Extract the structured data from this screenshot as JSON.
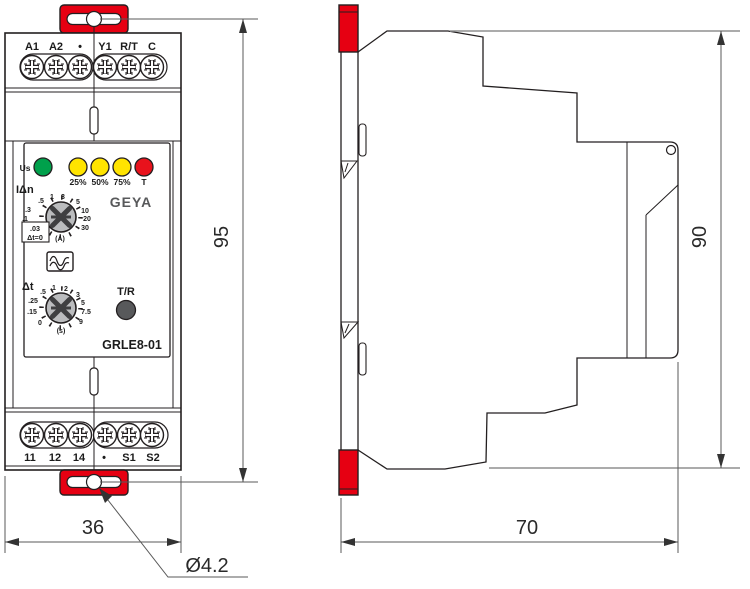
{
  "drawing": {
    "front": {
      "terminals_top": [
        "A1",
        "A2",
        "•",
        "Y1",
        "R/T",
        "C"
      ],
      "terminals_bottom": [
        "11",
        "12",
        "14",
        "•",
        "S1",
        "S2"
      ],
      "leds": {
        "power_label": "Us",
        "colors": [
          "#00A04B",
          "#FFE400",
          "#FFE400",
          "#FFE400",
          "#E8121C"
        ],
        "labels": [
          "25%",
          "50%",
          "75%",
          "T"
        ]
      },
      "brand": "GEYA",
      "model": "GRLE8-01",
      "current_dial": {
        "label": "IΔn",
        "unit": "(A)",
        "scale": [
          ".5",
          "1",
          "3",
          "5",
          "10",
          "20",
          "30",
          ".3",
          ".1"
        ],
        "box_value": ".03",
        "box_note": "Δt=0"
      },
      "time_dial": {
        "label": "Δt",
        "unit": "(s)",
        "scale": [
          ".5",
          "1",
          "2",
          "3",
          "5",
          "7.5",
          "9",
          "0",
          ".15",
          ".25"
        ]
      },
      "test_reset_label": "T/R"
    },
    "dimensions": {
      "front_height": "95",
      "front_width": "36",
      "side_height": "90",
      "side_depth": "70",
      "hole_diameter": "Ø4.2"
    },
    "colors": {
      "mount_red": "#E60012",
      "dial_gray": "#BBBCBE",
      "knob_dark": "#3F3F41",
      "button_gray": "#58595B"
    }
  }
}
